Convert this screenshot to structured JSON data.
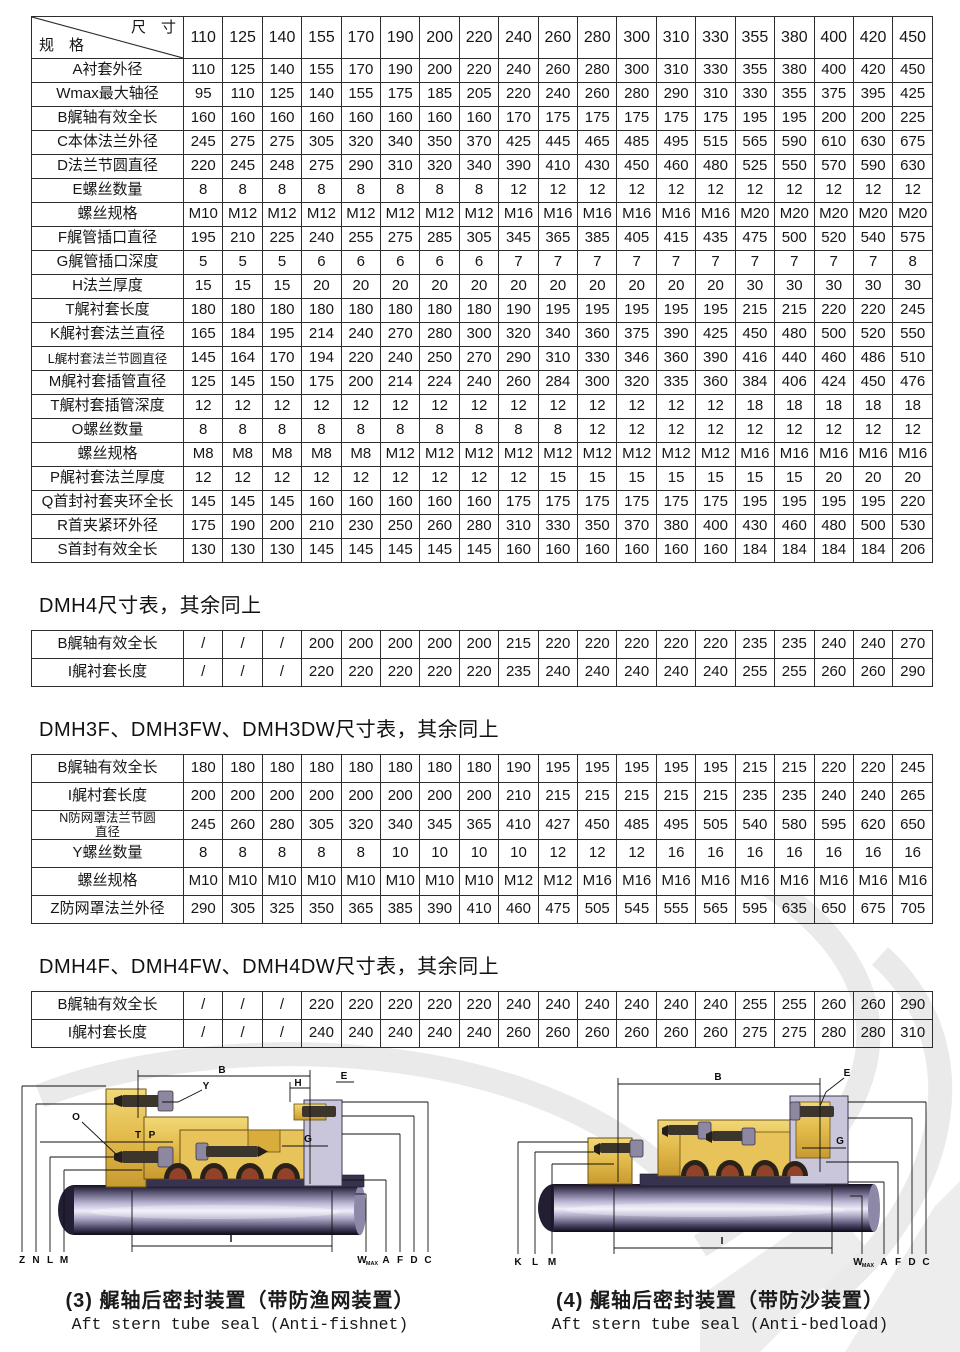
{
  "main_table": {
    "corner": {
      "top": "尺　寸",
      "bottom": "规　格"
    },
    "sizes": [
      "110",
      "125",
      "140",
      "155",
      "170",
      "190",
      "200",
      "220",
      "240",
      "260",
      "280",
      "300",
      "310",
      "330",
      "355",
      "380",
      "400",
      "420",
      "450"
    ],
    "rows": [
      {
        "label": "A衬套外径",
        "values": [
          "110",
          "125",
          "140",
          "155",
          "170",
          "190",
          "200",
          "220",
          "240",
          "260",
          "280",
          "300",
          "310",
          "330",
          "355",
          "380",
          "400",
          "420",
          "450"
        ]
      },
      {
        "label": "Wmax最大轴径",
        "values": [
          "95",
          "110",
          "125",
          "140",
          "155",
          "175",
          "185",
          "205",
          "220",
          "240",
          "260",
          "280",
          "290",
          "310",
          "330",
          "355",
          "375",
          "395",
          "425"
        ]
      },
      {
        "label": "B艉轴有效全长",
        "values": [
          "160",
          "160",
          "160",
          "160",
          "160",
          "160",
          "160",
          "160",
          "170",
          "175",
          "175",
          "175",
          "175",
          "175",
          "195",
          "195",
          "200",
          "200",
          "225"
        ]
      },
      {
        "label": "C本体法兰外径",
        "values": [
          "245",
          "275",
          "275",
          "305",
          "320",
          "340",
          "350",
          "370",
          "425",
          "445",
          "465",
          "485",
          "495",
          "515",
          "565",
          "590",
          "610",
          "630",
          "675"
        ]
      },
      {
        "label": "D法兰节圆直径",
        "values": [
          "220",
          "245",
          "248",
          "275",
          "290",
          "310",
          "320",
          "340",
          "390",
          "410",
          "430",
          "450",
          "460",
          "480",
          "525",
          "550",
          "570",
          "590",
          "630"
        ]
      },
      {
        "label": "E螺丝数量",
        "values": [
          "8",
          "8",
          "8",
          "8",
          "8",
          "8",
          "8",
          "8",
          "12",
          "12",
          "12",
          "12",
          "12",
          "12",
          "12",
          "12",
          "12",
          "12",
          "12"
        ]
      },
      {
        "label": "螺丝规格",
        "values": [
          "M10",
          "M12",
          "M12",
          "M12",
          "M12",
          "M12",
          "M12",
          "M12",
          "M16",
          "M16",
          "M16",
          "M16",
          "M16",
          "M16",
          "M20",
          "M20",
          "M20",
          "M20",
          "M20"
        ]
      },
      {
        "label": "F艉管插口直径",
        "values": [
          "195",
          "210",
          "225",
          "240",
          "255",
          "275",
          "285",
          "305",
          "345",
          "365",
          "385",
          "405",
          "415",
          "435",
          "475",
          "500",
          "520",
          "540",
          "575"
        ]
      },
      {
        "label": "G艉管插口深度",
        "values": [
          "5",
          "5",
          "5",
          "6",
          "6",
          "6",
          "6",
          "6",
          "7",
          "7",
          "7",
          "7",
          "7",
          "7",
          "7",
          "7",
          "7",
          "7",
          "8"
        ]
      },
      {
        "label": "H法兰厚度",
        "values": [
          "15",
          "15",
          "15",
          "20",
          "20",
          "20",
          "20",
          "20",
          "20",
          "20",
          "20",
          "20",
          "20",
          "20",
          "30",
          "30",
          "30",
          "30",
          "30"
        ]
      },
      {
        "label": "T艉衬套长度",
        "values": [
          "180",
          "180",
          "180",
          "180",
          "180",
          "180",
          "180",
          "180",
          "190",
          "195",
          "195",
          "195",
          "195",
          "195",
          "215",
          "215",
          "220",
          "220",
          "245"
        ]
      },
      {
        "label": "K艉衬套法兰直径",
        "values": [
          "165",
          "184",
          "195",
          "214",
          "240",
          "270",
          "280",
          "300",
          "320",
          "340",
          "360",
          "375",
          "390",
          "425",
          "450",
          "480",
          "500",
          "520",
          "550"
        ]
      },
      {
        "label": "L艉村套法兰节圆直径",
        "small": true,
        "values": [
          "145",
          "164",
          "170",
          "194",
          "220",
          "240",
          "250",
          "270",
          "290",
          "310",
          "330",
          "346",
          "360",
          "390",
          "416",
          "440",
          "460",
          "486",
          "510"
        ]
      },
      {
        "label": "M艉衬套插管直径",
        "values": [
          "125",
          "145",
          "150",
          "175",
          "200",
          "214",
          "224",
          "240",
          "260",
          "284",
          "300",
          "320",
          "335",
          "360",
          "384",
          "406",
          "424",
          "450",
          "476"
        ]
      },
      {
        "label": "T艉村套插管深度",
        "values": [
          "12",
          "12",
          "12",
          "12",
          "12",
          "12",
          "12",
          "12",
          "12",
          "12",
          "12",
          "12",
          "12",
          "12",
          "18",
          "18",
          "18",
          "18",
          "18"
        ]
      },
      {
        "label": "O螺丝数量",
        "values": [
          "8",
          "8",
          "8",
          "8",
          "8",
          "8",
          "8",
          "8",
          "8",
          "8",
          "12",
          "12",
          "12",
          "12",
          "12",
          "12",
          "12",
          "12",
          "12"
        ]
      },
      {
        "label": "螺丝规格",
        "values": [
          "M8",
          "M8",
          "M8",
          "M8",
          "M8",
          "M12",
          "M12",
          "M12",
          "M12",
          "M12",
          "M12",
          "M12",
          "M12",
          "M12",
          "M16",
          "M16",
          "M16",
          "M16",
          "M16"
        ]
      },
      {
        "label": "P艉衬套法兰厚度",
        "values": [
          "12",
          "12",
          "12",
          "12",
          "12",
          "12",
          "12",
          "12",
          "12",
          "15",
          "15",
          "15",
          "15",
          "15",
          "15",
          "15",
          "20",
          "20",
          "20"
        ]
      },
      {
        "label": "Q首封衬套夹环全长",
        "values": [
          "145",
          "145",
          "145",
          "160",
          "160",
          "160",
          "160",
          "160",
          "175",
          "175",
          "175",
          "175",
          "175",
          "175",
          "195",
          "195",
          "195",
          "195",
          "220"
        ]
      },
      {
        "label": "R首夹紧环外径",
        "values": [
          "175",
          "190",
          "200",
          "210",
          "230",
          "250",
          "260",
          "280",
          "310",
          "330",
          "350",
          "370",
          "380",
          "400",
          "430",
          "460",
          "480",
          "500",
          "530"
        ]
      },
      {
        "label": "S首封有效全长",
        "values": [
          "130",
          "130",
          "130",
          "145",
          "145",
          "145",
          "145",
          "145",
          "160",
          "160",
          "160",
          "160",
          "160",
          "160",
          "184",
          "184",
          "184",
          "184",
          "206"
        ]
      }
    ]
  },
  "section_dmh4": {
    "title": "DMH4尺寸表，其余同上",
    "rows": [
      {
        "label": "B艉轴有效全长",
        "values": [
          "/",
          "/",
          "/",
          "200",
          "200",
          "200",
          "200",
          "200",
          "215",
          "220",
          "220",
          "220",
          "220",
          "220",
          "235",
          "235",
          "240",
          "240",
          "270"
        ]
      },
      {
        "label": "I艉衬套长度",
        "values": [
          "/",
          "/",
          "/",
          "220",
          "220",
          "220",
          "220",
          "220",
          "235",
          "240",
          "240",
          "240",
          "240",
          "240",
          "255",
          "255",
          "260",
          "260",
          "290"
        ]
      }
    ]
  },
  "section_dmh3f": {
    "title": "DMH3F、DMH3FW、DMH3DW尺寸表，其余同上",
    "rows": [
      {
        "label": "B艉轴有效全长",
        "values": [
          "180",
          "180",
          "180",
          "180",
          "180",
          "180",
          "180",
          "180",
          "190",
          "195",
          "195",
          "195",
          "195",
          "195",
          "215",
          "215",
          "220",
          "220",
          "245"
        ]
      },
      {
        "label": "I艉村套长度",
        "values": [
          "200",
          "200",
          "200",
          "200",
          "200",
          "200",
          "200",
          "200",
          "210",
          "215",
          "215",
          "215",
          "215",
          "215",
          "235",
          "235",
          "240",
          "240",
          "265"
        ]
      },
      {
        "label": "N防网罩法兰节圆\n直径",
        "small": true,
        "values": [
          "245",
          "260",
          "280",
          "305",
          "320",
          "340",
          "345",
          "365",
          "410",
          "427",
          "450",
          "485",
          "495",
          "505",
          "540",
          "580",
          "595",
          "620",
          "650"
        ]
      },
      {
        "label": "Y螺丝数量",
        "values": [
          "8",
          "8",
          "8",
          "8",
          "8",
          "10",
          "10",
          "10",
          "10",
          "12",
          "12",
          "12",
          "16",
          "16",
          "16",
          "16",
          "16",
          "16",
          "16"
        ]
      },
      {
        "label": "螺丝规格",
        "values": [
          "M10",
          "M10",
          "M10",
          "M10",
          "M10",
          "M10",
          "M10",
          "M10",
          "M12",
          "M12",
          "M16",
          "M16",
          "M16",
          "M16",
          "M16",
          "M16",
          "M16",
          "M16",
          "M16"
        ]
      },
      {
        "label": "Z防网罩法兰外径",
        "values": [
          "290",
          "305",
          "325",
          "350",
          "365",
          "385",
          "390",
          "410",
          "460",
          "475",
          "505",
          "545",
          "555",
          "565",
          "595",
          "635",
          "650",
          "675",
          "705"
        ]
      }
    ]
  },
  "section_dmh4f": {
    "title": "DMH4F、DMH4FW、DMH4DW尺寸表，其余同上",
    "rows": [
      {
        "label": "B艉轴有效全长",
        "values": [
          "/",
          "/",
          "/",
          "220",
          "220",
          "220",
          "220",
          "220",
          "240",
          "240",
          "240",
          "240",
          "240",
          "240",
          "255",
          "255",
          "260",
          "260",
          "290"
        ]
      },
      {
        "label": "I艉村套长度",
        "values": [
          "/",
          "/",
          "/",
          "240",
          "240",
          "240",
          "240",
          "240",
          "260",
          "260",
          "260",
          "260",
          "260",
          "260",
          "275",
          "275",
          "280",
          "280",
          "310"
        ]
      }
    ]
  },
  "figures": [
    {
      "caption_zh": "(3) 艉轴后密封装置（带防渔网装置）",
      "caption_en": "Aft stern tube seal (Anti-fishnet)",
      "labels": {
        "b": "B",
        "y": "Y",
        "h": "H",
        "e": "E",
        "o": "O",
        "t": "T",
        "p": "P",
        "g": "G",
        "z": "Z",
        "n": "N",
        "l": "L",
        "m": "M",
        "i": "I",
        "w": "W",
        "wsub": "MAX",
        "a": "A",
        "f": "F",
        "d": "D",
        "c": "C"
      }
    },
    {
      "caption_zh": "(4) 艉轴后密封装置（带防沙装置）",
      "caption_en": "Aft stern tube seal (Anti-bedload)",
      "labels": {
        "b": "B",
        "e": "E",
        "g": "G",
        "k": "K",
        "l": "L",
        "m": "M",
        "i": "I",
        "w": "W",
        "wsub": "MAX",
        "a": "A",
        "f": "F",
        "d": "D",
        "c": "C"
      }
    }
  ],
  "colors": {
    "housing_gold": "#e2ba4a",
    "flange_gray": "#c9c5da",
    "shaft_light": "#efecf8",
    "watermark": "#e9e9e9"
  }
}
